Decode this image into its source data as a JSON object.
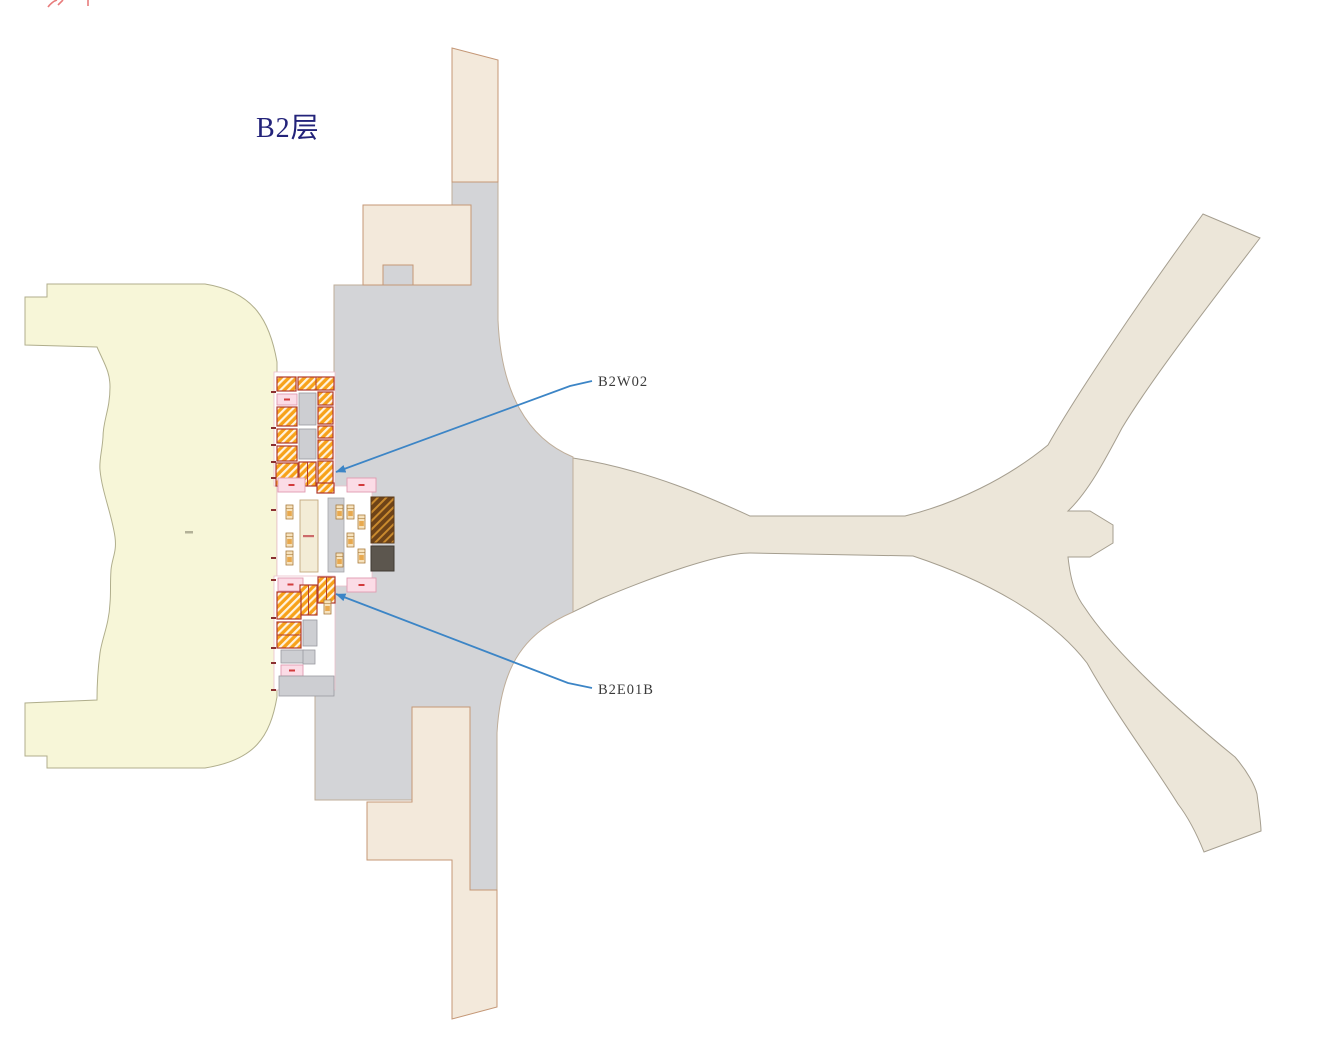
{
  "title": {
    "text": "B2层",
    "color": "#23237a"
  },
  "callouts": {
    "b2w02": {
      "label": "B2W02",
      "points": "592,381 570,386 336,472",
      "label_x": 598,
      "label_y": 386
    },
    "b2e01b": {
      "label": "B2E01B",
      "points": "592,688 568,683 336,594",
      "label_x": 598,
      "label_y": 694
    }
  },
  "colors": {
    "apron_fill": "#f7f6d8",
    "apron_stroke": "#b0ae8c",
    "core_fill": "#d3d4d7",
    "core_stroke": "#bfae9a",
    "annex_fill": "#f3e9db",
    "annex_stroke": "#c49776",
    "pier_fill": "#ece6d9",
    "pier_stroke": "#a59e8f",
    "room_hatch_orange": "#f7a21a",
    "room_hatch_stripe": "#fff3e0",
    "room_hatch_border": "#b03a2e",
    "room_gray": "#cdced2",
    "room_pink": "#fbdce6",
    "room_pink_border": "#e09ab0",
    "platform_fill": "#f3ecd6",
    "platform_border": "#c2a87e",
    "dark_hatch_bg": "#6e4318",
    "dark_hatch_stripe": "#c98a2e",
    "dark_gray": "#5c564e",
    "leader_blue": "#3c85c6",
    "tick_red": "#8b3030",
    "truncated_text_red": "#e87c7c",
    "white_zone_border": "#ecc0cc"
  },
  "plan": {
    "paths": {
      "west_apron": "M25,297 L47,297 L47,284 L205,284 C255,292 270,322 277,362 L277,697 C270,737 255,760 205,768 L47,768 L47,756 L25,756 L25,703 L97,700 C97,683 98,668 100,653 C102,638 109,625 110,603 C111,592 110,585 111,570 C112,558 117,552 115,537 C112,515 102,492 100,470 C99,460 102,452 103,437 C103,420 110,410 110,387 C110,372 105,365 97,347 L25,345 Z",
      "east_pier": "M573,458 C650,470 715,500 750,516 L905,516 C955,504 1008,478 1048,445 C1075,397 1140,300 1203,214 L1260,238 C1215,297 1152,378 1122,428 C1104,462 1088,492 1068,511 L1090,511 L1113,525 L1113,543 L1090,557 L1068,557 C1071,584 1076,596 1085,608 C1108,643 1160,696 1235,757 C1248,772 1255,786 1257,794 C1259,811 1261,823 1261,831 L1204,852 C1196,832 1188,817 1178,804 C1152,762 1118,718 1087,663 C1050,615 985,580 913,556 L750,553 C718,553 650,578 600,599 L573,612 Z",
      "terminal_core": "M334,285 L452,285 L452,182 L498,182 L498,320 C501,392 527,438 573,457 L573,612 C527,632 501,662 497,733 L497,890 L470,890 L470,802 L412,802 L412,800 L315,800 L315,690 L334,690 Z",
      "north_tower": "M452,48 L498,60 L498,182 L452,182 Z",
      "south_annex": "M412,707 L470,707 L470,890 L497,890 L497,1007 L452,1019 L452,860 L367,860 L367,802 L412,802 Z"
    },
    "north_block": {
      "x": 363,
      "y": 205,
      "w": 108,
      "h": 80
    },
    "north_notch": {
      "x": 383,
      "y": 265,
      "w": 30,
      "h": 20
    },
    "white_zones": [
      {
        "x": 274,
        "y": 372,
        "w": 61,
        "h": 114
      },
      {
        "x": 277,
        "y": 486,
        "w": 95,
        "h": 100
      },
      {
        "x": 274,
        "y": 576,
        "w": 61,
        "h": 114
      }
    ],
    "rooms": [
      {
        "x": 277,
        "y": 377,
        "w": 19,
        "h": 14,
        "t": "hatch"
      },
      {
        "x": 298,
        "y": 377,
        "w": 36,
        "h": 13,
        "t": "hatch",
        "d": "v"
      },
      {
        "x": 277,
        "y": 394,
        "w": 20,
        "h": 11,
        "t": "pink"
      },
      {
        "x": 299,
        "y": 393,
        "w": 17,
        "h": 32,
        "t": "gray"
      },
      {
        "x": 318,
        "y": 392,
        "w": 15,
        "h": 13,
        "t": "hatch"
      },
      {
        "x": 277,
        "y": 407,
        "w": 20,
        "h": 19,
        "t": "hatch"
      },
      {
        "x": 318,
        "y": 407,
        "w": 15,
        "h": 17,
        "t": "hatch"
      },
      {
        "x": 277,
        "y": 429,
        "w": 20,
        "h": 14,
        "t": "hatch"
      },
      {
        "x": 299,
        "y": 429,
        "w": 17,
        "h": 30,
        "t": "gray"
      },
      {
        "x": 318,
        "y": 426,
        "w": 15,
        "h": 12,
        "t": "hatch"
      },
      {
        "x": 277,
        "y": 446,
        "w": 20,
        "h": 15,
        "t": "hatch"
      },
      {
        "x": 318,
        "y": 440,
        "w": 15,
        "h": 19,
        "t": "hatch"
      },
      {
        "x": 276,
        "y": 463,
        "w": 22,
        "h": 23,
        "t": "hatch"
      },
      {
        "x": 299,
        "y": 462,
        "w": 17,
        "h": 24,
        "t": "hatch",
        "d": "v"
      },
      {
        "x": 318,
        "y": 461,
        "w": 15,
        "h": 24,
        "t": "hatch"
      },
      {
        "x": 278,
        "y": 478,
        "w": 27,
        "h": 14,
        "t": "pink"
      },
      {
        "x": 347,
        "y": 478,
        "w": 29,
        "h": 14,
        "t": "pink"
      },
      {
        "x": 317,
        "y": 483,
        "w": 17,
        "h": 10,
        "t": "hatch"
      },
      {
        "x": 300,
        "y": 500,
        "w": 18,
        "h": 72,
        "t": "platform"
      },
      {
        "x": 328,
        "y": 498,
        "w": 16,
        "h": 74,
        "t": "slab"
      },
      {
        "x": 371,
        "y": 497,
        "w": 23,
        "h": 46,
        "t": "dkhatch"
      },
      {
        "x": 371,
        "y": 546,
        "w": 23,
        "h": 25,
        "t": "dkgray"
      },
      {
        "x": 278,
        "y": 578,
        "w": 25,
        "h": 13,
        "t": "pink"
      },
      {
        "x": 347,
        "y": 578,
        "w": 29,
        "h": 14,
        "t": "pink"
      },
      {
        "x": 318,
        "y": 577,
        "w": 17,
        "h": 26,
        "t": "hatch",
        "d": "v"
      },
      {
        "x": 300,
        "y": 585,
        "w": 17,
        "h": 30,
        "t": "hatch",
        "d": "v"
      },
      {
        "x": 277,
        "y": 592,
        "w": 24,
        "h": 27,
        "t": "hatch"
      },
      {
        "x": 277,
        "y": 622,
        "w": 24,
        "h": 26,
        "t": "hatch",
        "d": "h"
      },
      {
        "x": 281,
        "y": 650,
        "w": 23,
        "h": 13,
        "t": "gray"
      },
      {
        "x": 303,
        "y": 620,
        "w": 14,
        "h": 26,
        "t": "gray"
      },
      {
        "x": 303,
        "y": 650,
        "w": 12,
        "h": 14,
        "t": "gray"
      },
      {
        "x": 281,
        "y": 665,
        "w": 22,
        "h": 11,
        "t": "pink"
      },
      {
        "x": 279,
        "y": 676,
        "w": 55,
        "h": 20,
        "t": "gray"
      }
    ],
    "escalators": [
      [
        286,
        505
      ],
      [
        286,
        533
      ],
      [
        286,
        551
      ],
      [
        347,
        505
      ],
      [
        347,
        533
      ],
      [
        358,
        515
      ],
      [
        358,
        549
      ],
      [
        336,
        505
      ],
      [
        336,
        553
      ],
      [
        324,
        600
      ]
    ],
    "ticks": [
      391,
      427,
      444,
      461,
      477,
      509,
      557,
      579,
      617,
      647,
      662,
      689
    ]
  }
}
